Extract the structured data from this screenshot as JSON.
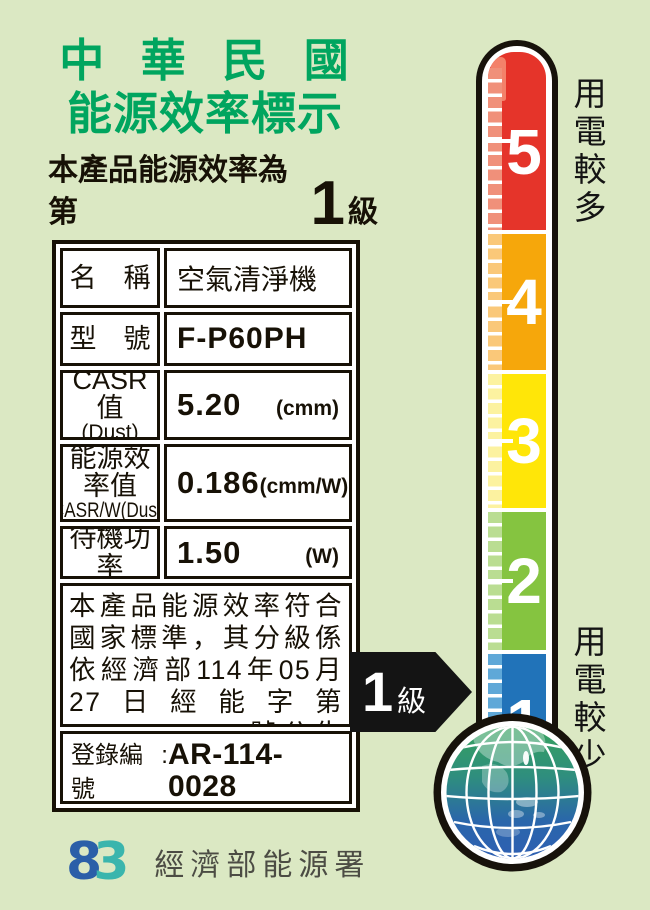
{
  "label": {
    "title_line1": "中 華 民 國",
    "title_line2": "能源效率標示",
    "title_color": "#00a55f",
    "subtitle_prefix": "本產品能源效率為第",
    "subtitle_grade": "1",
    "subtitle_suffix": "級"
  },
  "table": {
    "rows": {
      "name": {
        "label": "名　稱",
        "value": "空氣清淨機"
      },
      "model": {
        "label": "型　號",
        "value": "F-P60PH"
      },
      "casr": {
        "label_line1": "CASR值",
        "label_line2": "(Dust)",
        "value": "5.20",
        "unit": "(cmm)"
      },
      "eff": {
        "label_line1": "能源效率值",
        "label_line2": "CASR/W(Dust)",
        "value": "0.186",
        "unit": "(cmm/W)"
      },
      "standby": {
        "label": "待機功率",
        "value": "1.50",
        "unit": "(W)"
      }
    },
    "statement": "本產品能源效率符合國家標準，其分級係依經濟部114年05月27日經能字第11458002290號公告之能源效率分級標示表標示",
    "registration_label": "登錄編號",
    "registration_sep": " : ",
    "registration_number": "AR-114-0028"
  },
  "thermometer": {
    "top_caption": "用電較多",
    "bottom_caption": "用電較少",
    "levels": [
      {
        "value": "5",
        "color": "#e5342a",
        "light": "#f0907a"
      },
      {
        "value": "4",
        "color": "#f6a70b",
        "light": "#fac879"
      },
      {
        "value": "3",
        "color": "#ffe608",
        "light": "#fcf2a0"
      },
      {
        "value": "2",
        "color": "#85c440",
        "light": "#badd92"
      },
      {
        "value": "1",
        "color": "#2173b9",
        "light": "#5fa8d8"
      }
    ]
  },
  "grade_arrow": {
    "number": "1",
    "suffix": "級"
  },
  "footer": {
    "logo_left": "8",
    "logo_right": "3",
    "logo_left_color": "#2b5fa8",
    "logo_right_color": "#3ab5ad",
    "agency": "經濟部能源署"
  },
  "colors": {
    "background": "#dbe8c3",
    "outline": "#17120b"
  }
}
